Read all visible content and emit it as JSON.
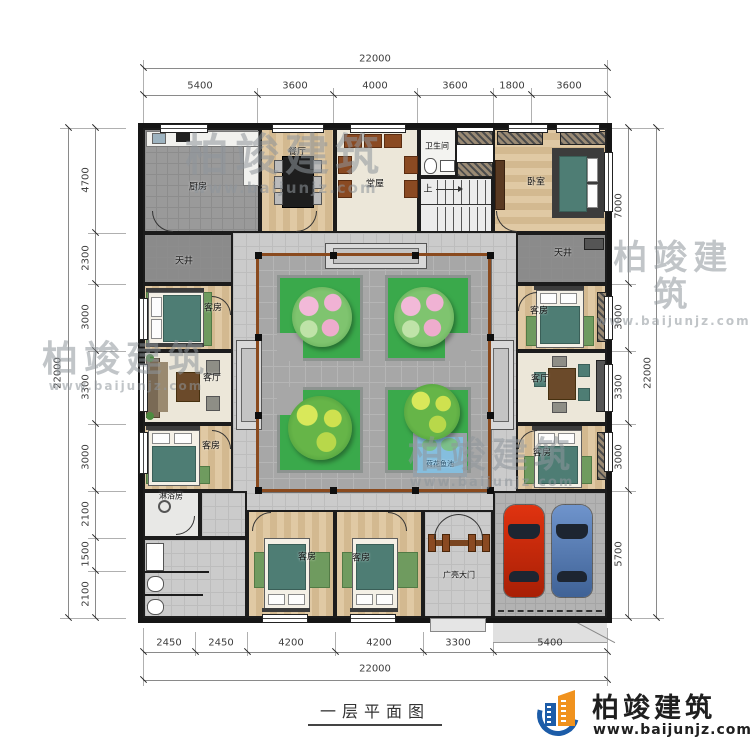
{
  "title": {
    "text": "一层平面图"
  },
  "branding": {
    "name": "柏竣建筑",
    "url": "www.baijunjz.com"
  },
  "watermark": {
    "name": "柏竣建筑",
    "url": "www.baijunjz.com"
  },
  "dimensions": {
    "top": {
      "overall": "22000",
      "segments": [
        "5400",
        "3600",
        "4000",
        "3600",
        "1800",
        "3600"
      ]
    },
    "bottom": {
      "overall": "22000",
      "segments": [
        "2450",
        "2450",
        "4200",
        "4200",
        "3300",
        "5400"
      ]
    },
    "left": {
      "overall": "22000",
      "segments": [
        "4700",
        "2300",
        "3000",
        "3300",
        "3000",
        "2100",
        "1500",
        "2100"
      ]
    },
    "right": {
      "overall": "22000",
      "segments": [
        "7000",
        "3000",
        "3300",
        "3000",
        "5700"
      ]
    }
  },
  "rooms": {
    "kitchen": "厨房",
    "dining": "餐厅",
    "hall": "堂屋",
    "bathroom": "卫生间",
    "stairs_up": "上",
    "bedroom": "卧室",
    "lightwell": "天井",
    "guest": "客房",
    "living": "客厅",
    "shower": "淋浴房",
    "pond": "荷花鱼池",
    "gate": "广亮大门"
  },
  "colors": {
    "wall": "#1c1c1c",
    "planter_green": "#3aa94b",
    "pond_blue": "#85bede",
    "car_red": "#c52a0c",
    "car_blue": "#5d83b8",
    "brand_blue": "#1c5ca8",
    "brand_orange": "#f0921e"
  }
}
